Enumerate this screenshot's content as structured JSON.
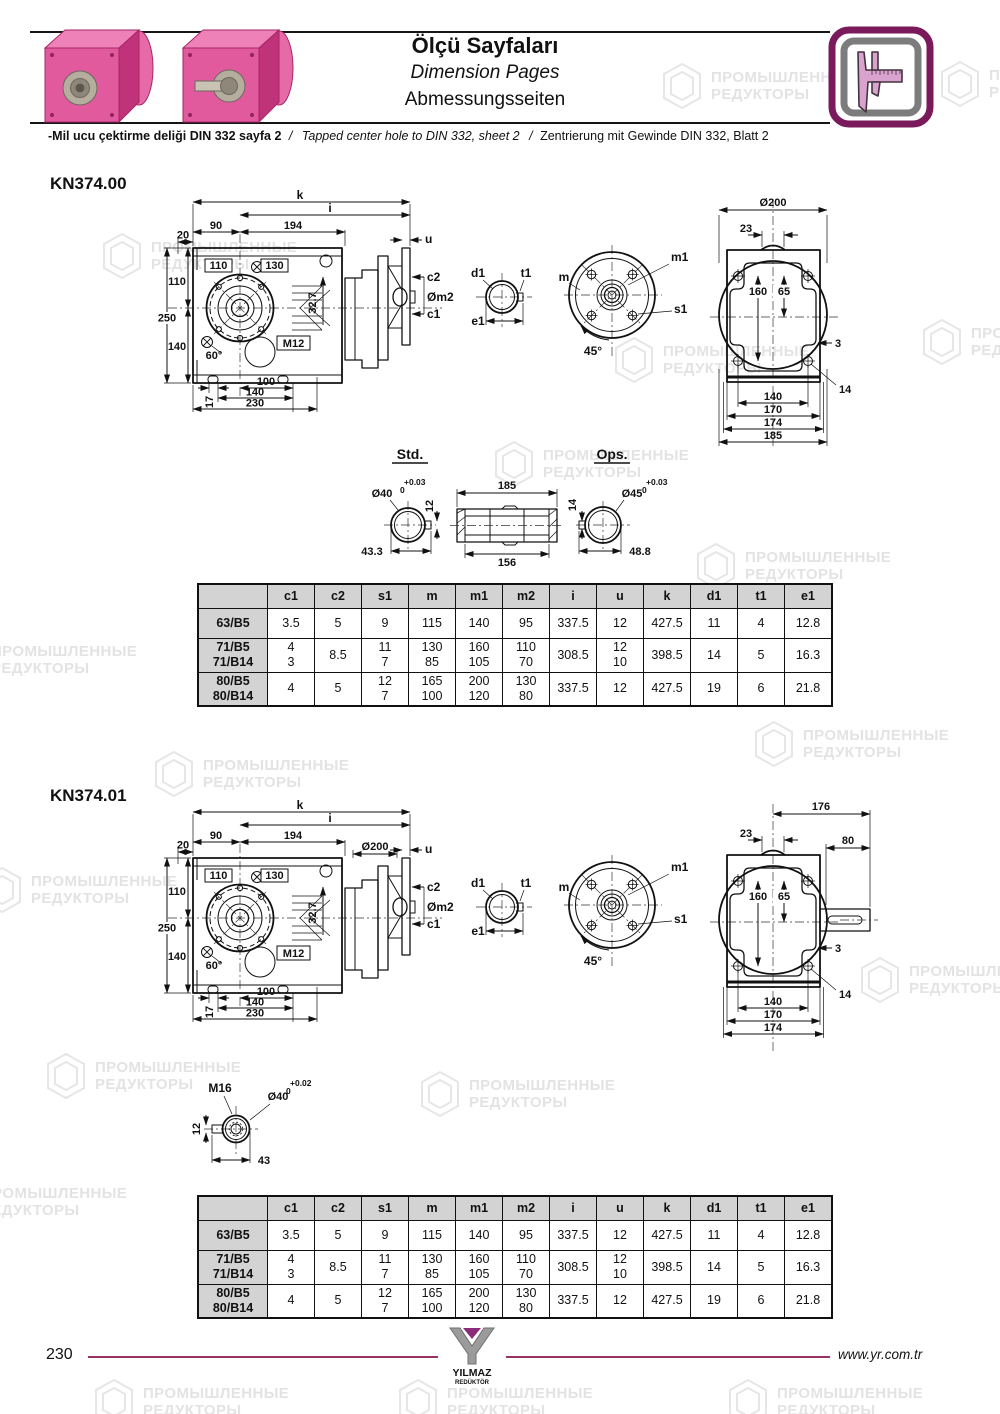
{
  "header": {
    "title_tr": "Ölçü Sayfaları",
    "title_en": "Dimension Pages",
    "title_de": "Abmessungsseiten"
  },
  "note": {
    "tr": "-Mil ucu çektirme deliği DIN 332 sayfa 2",
    "sep1": "/",
    "en": "Tapped center hole to DIN 332, sheet 2",
    "sep2": "/",
    "de": "Zentrierung mit Gewinde DIN 332, Blatt 2"
  },
  "watermark": {
    "line1": "ПРОМЫШЛЕННЫЕ",
    "line2": "РЕДУКТОРЫ"
  },
  "section1": {
    "title": "KN374.00"
  },
  "section2": {
    "title": "KN374.01"
  },
  "mv": {
    "k": "k",
    "i": "i",
    "u": "u",
    "d20": "20",
    "d90": "90",
    "d194": "194",
    "b110": "110",
    "b130": "130",
    "l110": "110",
    "l250": "250",
    "l140": "140",
    "c2": "c2",
    "om2": "Øm2",
    "c1": "c1",
    "d327": "32.7",
    "m12": "M12",
    "deg60": "60°",
    "d17": "17",
    "d100": "100",
    "d140": "140",
    "d230": "230",
    "d200": "Ø200"
  },
  "sv": {
    "d1": "d1",
    "t1": "t1",
    "e1": "e1"
  },
  "fv": {
    "m": "m",
    "m1": "m1",
    "s1": "s1",
    "deg45": "45°"
  },
  "rv": {
    "d23": "23",
    "d160": "160",
    "d65": "65",
    "d3": "3",
    "d14": "14",
    "d140": "140",
    "d170": "170",
    "d174": "174"
  },
  "rv0": {
    "d200": "Ø200",
    "d185": "185"
  },
  "rv1": {
    "d176": "176",
    "d80": "80"
  },
  "so": {
    "std": "Std.",
    "ops": "Ops.",
    "std_dia": "Ø40",
    "std_tol_top": "+0.03",
    "std_tol_bot": "0",
    "std_key": "12",
    "std_len": "43.3",
    "len_top": "185",
    "len_bot": "156",
    "ops_dia": "Ø45",
    "ops_tol_top": "+0.03",
    "ops_tol_bot": "0",
    "ops_key": "14",
    "ops_len": "48.8"
  },
  "hd": {
    "m16": "M16",
    "d12": "12",
    "dia": "Ø40",
    "tol_top": "+0.02",
    "tol_bot": "0",
    "d43": "43"
  },
  "dim_table": {
    "headers": [
      "",
      "c1",
      "c2",
      "s1",
      "m",
      "m1",
      "m2",
      "i",
      "u",
      "k",
      "d1",
      "t1",
      "e1"
    ],
    "rows": [
      {
        "label": [
          "63/B5"
        ],
        "values": [
          [
            "3.5"
          ],
          [
            "5"
          ],
          [
            "9"
          ],
          [
            "115"
          ],
          [
            "140"
          ],
          [
            "95"
          ],
          [
            "337.5"
          ],
          [
            "12"
          ],
          [
            "427.5"
          ],
          [
            "11"
          ],
          [
            "4"
          ],
          [
            "12.8"
          ]
        ]
      },
      {
        "label": [
          "71/B5",
          "71/B14"
        ],
        "values": [
          [
            "4",
            "3"
          ],
          [
            "8.5"
          ],
          [
            "11",
            "7"
          ],
          [
            "130",
            "85"
          ],
          [
            "160",
            "105"
          ],
          [
            "110",
            "70"
          ],
          [
            "308.5"
          ],
          [
            "12",
            "10"
          ],
          [
            "398.5"
          ],
          [
            "14"
          ],
          [
            "5"
          ],
          [
            "16.3"
          ]
        ]
      },
      {
        "label": [
          "80/B5",
          "80/B14"
        ],
        "values": [
          [
            "4"
          ],
          [
            "5"
          ],
          [
            "12",
            "7"
          ],
          [
            "165",
            "100"
          ],
          [
            "200",
            "120"
          ],
          [
            "130",
            "80"
          ],
          [
            "337.5"
          ],
          [
            "12"
          ],
          [
            "427.5"
          ],
          [
            "19"
          ],
          [
            "6"
          ],
          [
            "21.8"
          ]
        ]
      }
    ]
  },
  "footer": {
    "page": "230",
    "url": "www.yr.com.tr",
    "logo_name": "YILMAZ",
    "logo_sub": "REDÜKTÖR"
  },
  "icons": {
    "header_icon": "caliper-icon",
    "watermark_icon": "hexagon-swirl-icon",
    "logo_icon": "yilmaz-y-icon"
  }
}
